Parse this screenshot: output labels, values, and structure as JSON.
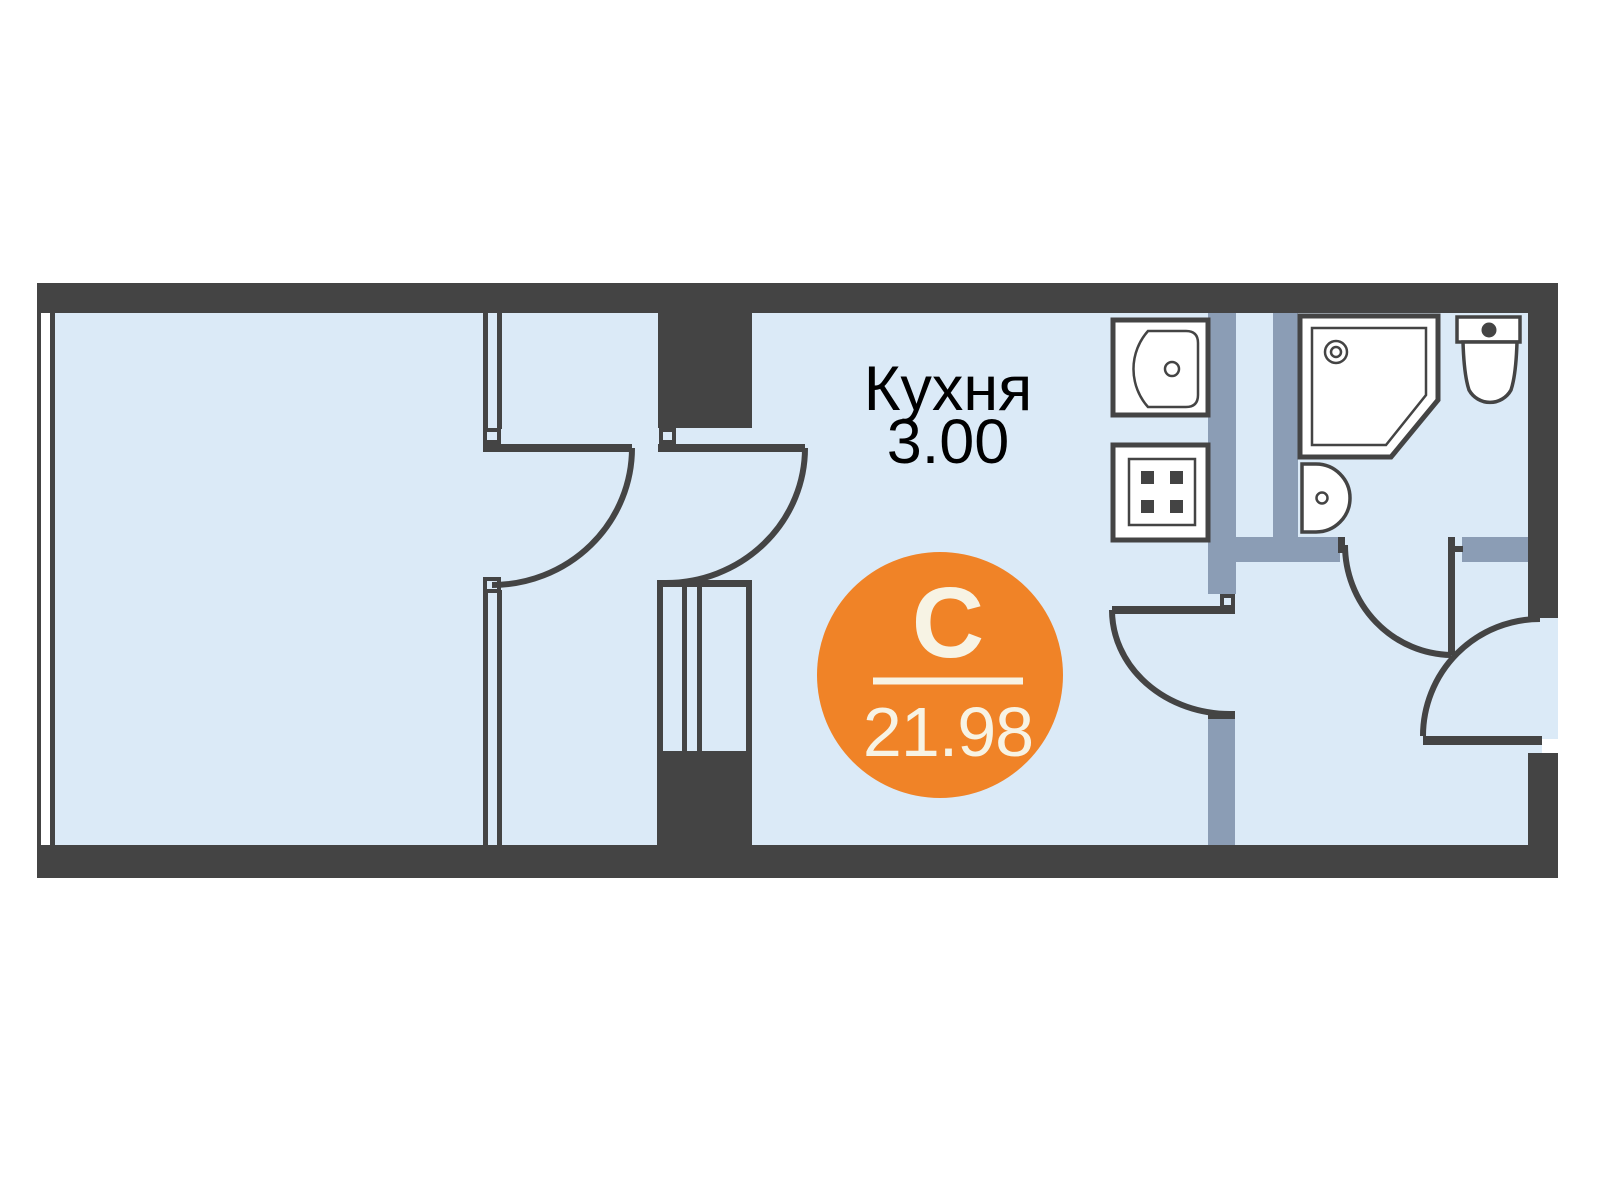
{
  "plan": {
    "kitchen_label": {
      "name": "Кухня",
      "area": "3.00"
    },
    "unit_badge": {
      "letter": "С",
      "area": "21.98"
    },
    "palette": {
      "wall_dark": "#444444",
      "floor_fill": "#DBEAF7",
      "partition_gray": "#8B9DB5",
      "badge_orange": "#F08327",
      "badge_text": "#F7F3E4",
      "label_black": "#000000",
      "fixture_white": "#FFFFFF"
    },
    "fixtures": {
      "kitchen": [
        "kitchen-sink",
        "stove"
      ],
      "bathroom": [
        "shower-cabin",
        "washbasin",
        "toilet"
      ]
    },
    "doors": [
      "room-door",
      "vestibule-door",
      "kitchen-door",
      "bathroom-door",
      "entry-door"
    ]
  }
}
